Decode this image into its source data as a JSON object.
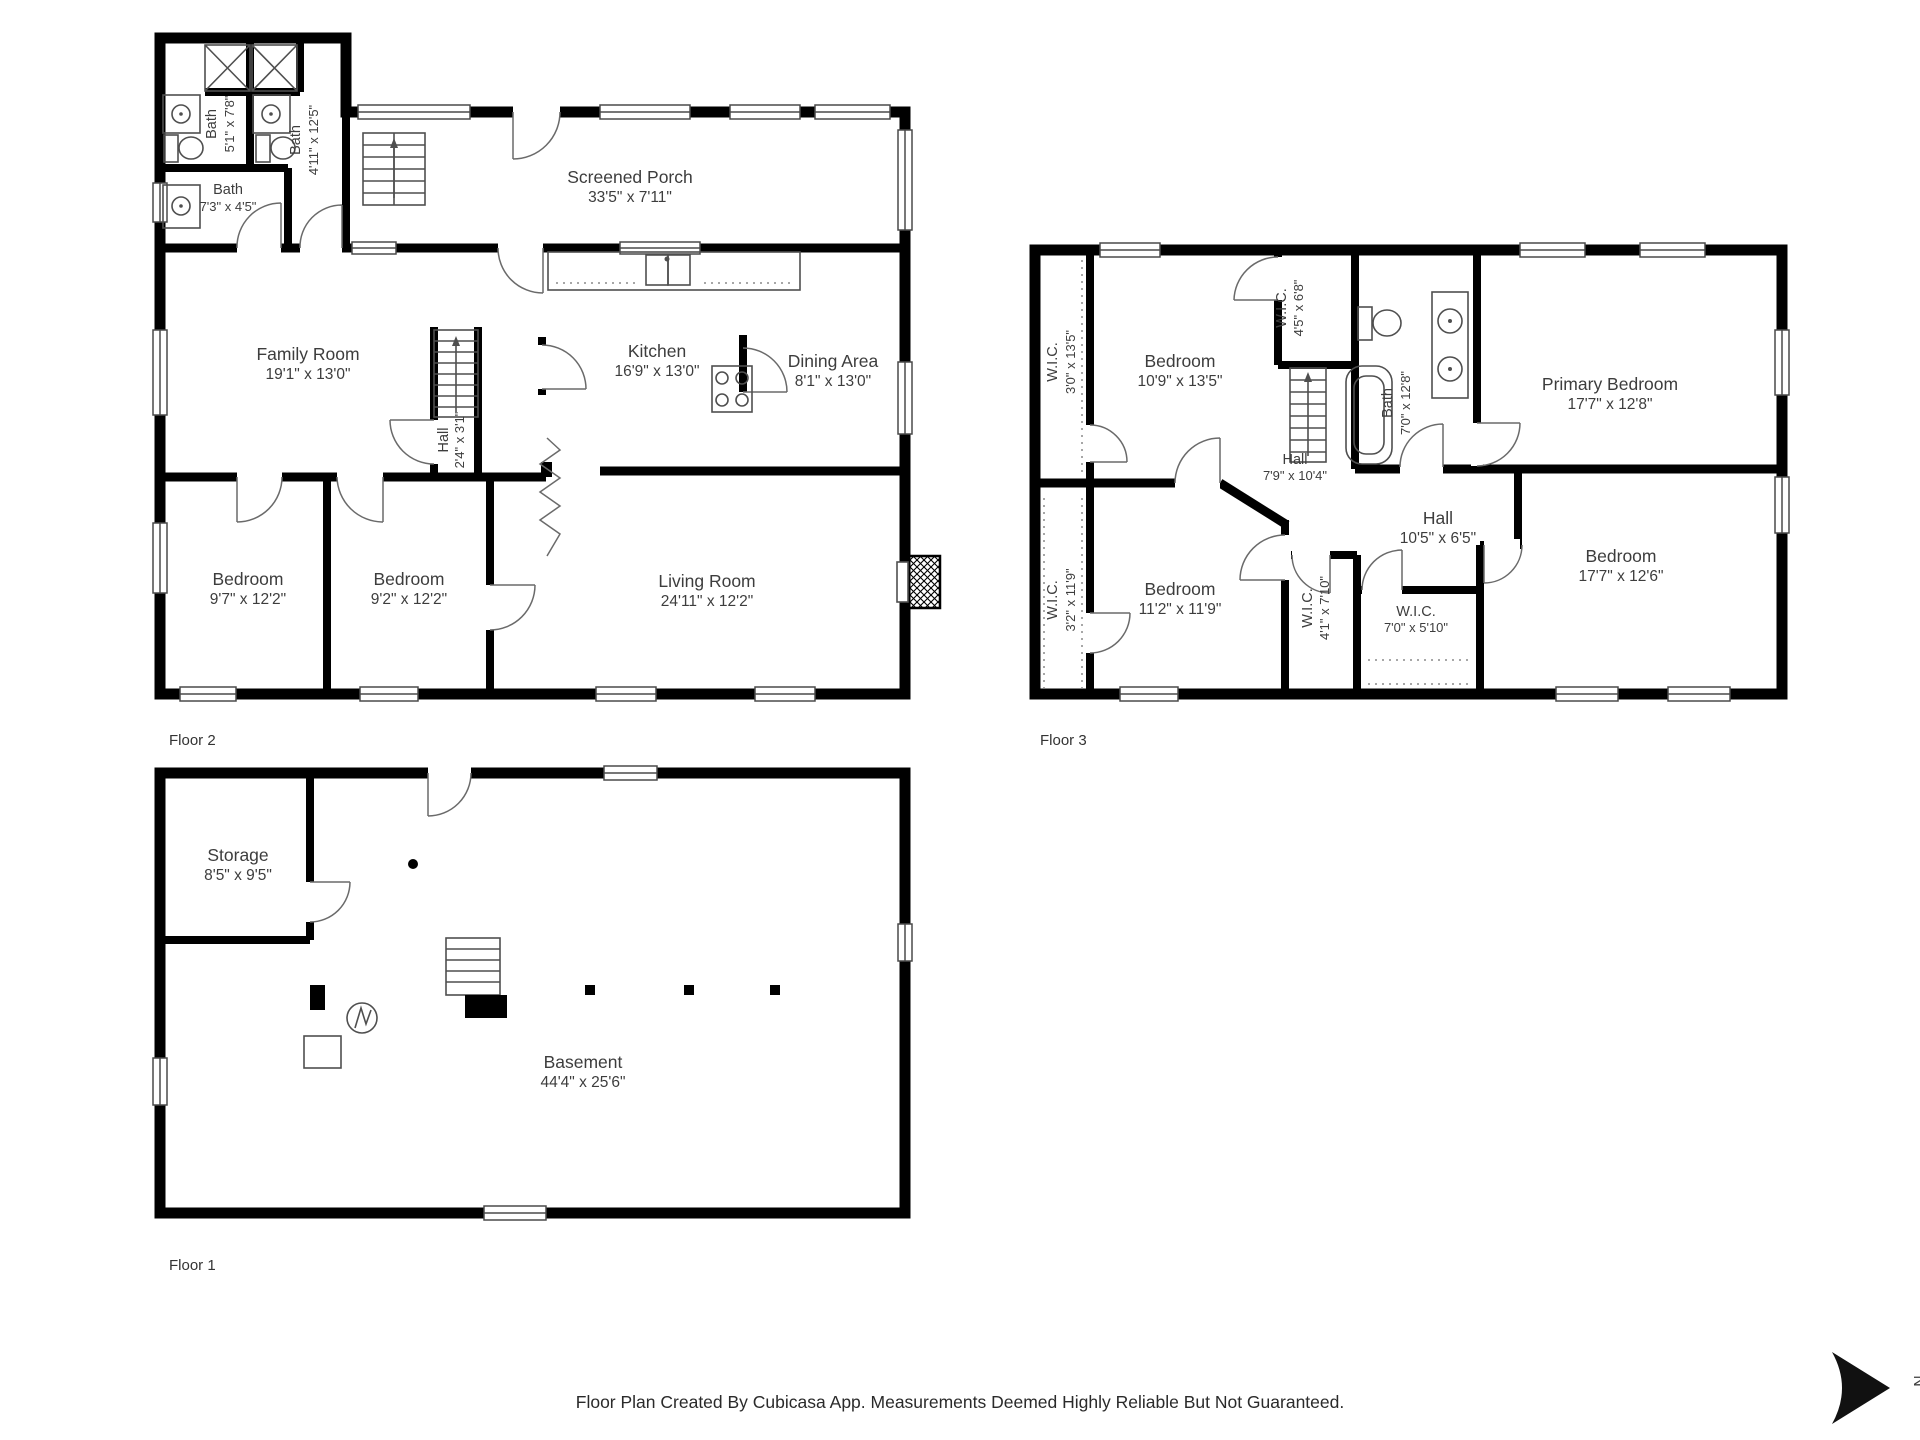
{
  "floors": [
    {
      "label": "Floor 2",
      "rooms": [
        {
          "name": "Bath",
          "dims": "5'1\" x 7'8\""
        },
        {
          "name": "Bath",
          "dims": "4'11\" x 12'5\""
        },
        {
          "name": "Bath",
          "dims": "7'3\" x 4'5\""
        },
        {
          "name": "Screened Porch",
          "dims": "33'5\" x 7'11\""
        },
        {
          "name": "Family Room",
          "dims": "19'1\" x 13'0\""
        },
        {
          "name": "Kitchen",
          "dims": "16'9\" x 13'0\""
        },
        {
          "name": "Dining Area",
          "dims": "8'1\" x 13'0\""
        },
        {
          "name": "Hall",
          "dims": "2'4\" x 3'1\""
        },
        {
          "name": "Bedroom",
          "dims": "9'7\" x 12'2\""
        },
        {
          "name": "Bedroom",
          "dims": "9'2\" x 12'2\""
        },
        {
          "name": "Living Room",
          "dims": "24'11\" x 12'2\""
        }
      ]
    },
    {
      "label": "Floor 3",
      "rooms": [
        {
          "name": "W.I.C.",
          "dims": "3'0\" x 13'5\""
        },
        {
          "name": "Bedroom",
          "dims": "10'9\" x 13'5\""
        },
        {
          "name": "W.I.C.",
          "dims": "4'5\" x 6'8\""
        },
        {
          "name": "Bath",
          "dims": "7'0\" x 12'8\""
        },
        {
          "name": "Primary Bedroom",
          "dims": "17'7\" x 12'8\""
        },
        {
          "name": "Hall",
          "dims": "7'9\" x 10'4\""
        },
        {
          "name": "Hall",
          "dims": "10'5\" x 6'5\""
        },
        {
          "name": "W.I.C.",
          "dims": "3'2\" x 11'9\""
        },
        {
          "name": "Bedroom",
          "dims": "11'2\" x 11'9\""
        },
        {
          "name": "W.I.C.",
          "dims": "4'1\" x 7'10\""
        },
        {
          "name": "W.I.C.",
          "dims": "7'0\" x 5'10\""
        },
        {
          "name": "Bedroom",
          "dims": "17'7\" x 12'6\""
        }
      ]
    },
    {
      "label": "Floor 1",
      "rooms": [
        {
          "name": "Storage",
          "dims": "8'5\" x 9'5\""
        },
        {
          "name": "Basement",
          "dims": "44'4\" x 25'6\""
        }
      ]
    }
  ],
  "footer": {
    "caption": "Floor Plan Created By Cubicasa App. Measurements Deemed Highly Reliable But Not Guaranteed.",
    "north_label": "N"
  },
  "colors": {
    "wall": "#000000",
    "fixture": "#4f4f4f",
    "text": "#3d3d3d"
  }
}
